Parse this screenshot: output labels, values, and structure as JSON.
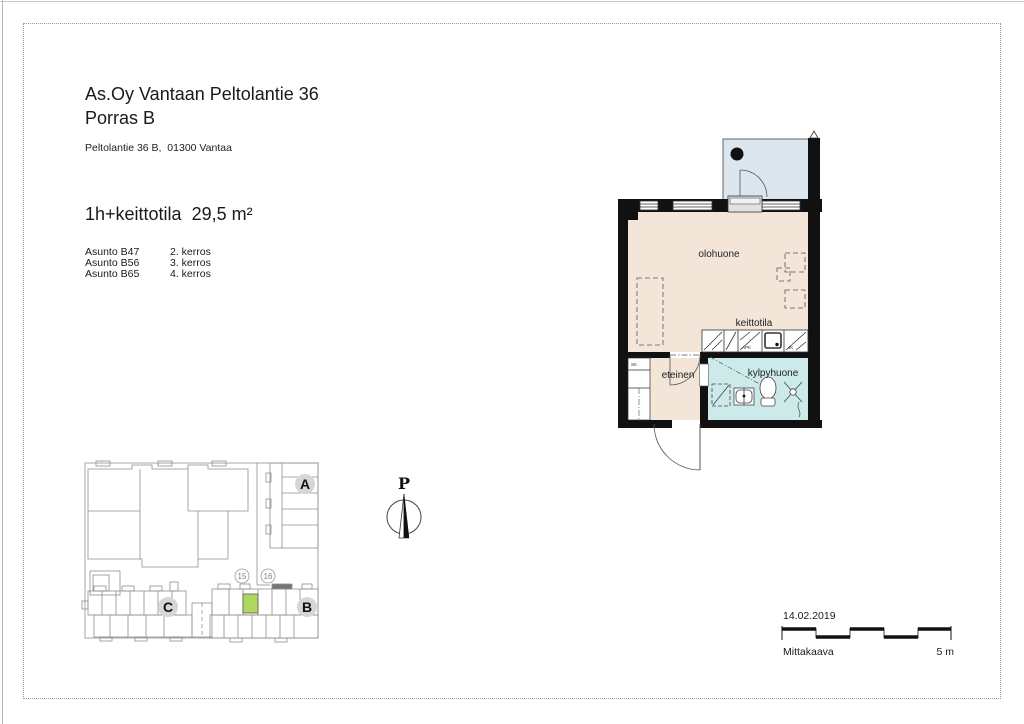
{
  "page": {
    "title_line1": "As.Oy Vantaan Peltolantie 36",
    "title_line2": "Porras B",
    "address": "Peltolantie 36 B,  01300 Vantaa",
    "apartment_type": "1h+keittotila  29,5 m²",
    "apartments": [
      {
        "id": "Asunto B47",
        "floor": "2. kerros"
      },
      {
        "id": "Asunto B56",
        "floor": "3. kerros"
      },
      {
        "id": "Asunto B65",
        "floor": "4. kerros"
      }
    ],
    "date": "14.02.2019",
    "scale_label": "Mittakaava",
    "scale_length": "5 m"
  },
  "floor_plan": {
    "room_labels": {
      "living": "olohuone",
      "kitchen": "keittotila",
      "bathroom": "kylpyhuone",
      "hall": "eteinen"
    },
    "fixture_labels": {
      "closet": "SK",
      "dishwasher": "APK",
      "fridge": "JK"
    },
    "colors": {
      "living": "#f3e6d9",
      "bathroom": "#cdeaea",
      "balcony": "#dbe6ee",
      "wall": "#111111",
      "highlight": "#aed75e"
    }
  },
  "site_plan": {
    "buildings": {
      "a": "A",
      "b": "B",
      "c": "C"
    },
    "stairs": {
      "s15": "15",
      "s16": "16"
    }
  },
  "north": {
    "label": "P"
  }
}
